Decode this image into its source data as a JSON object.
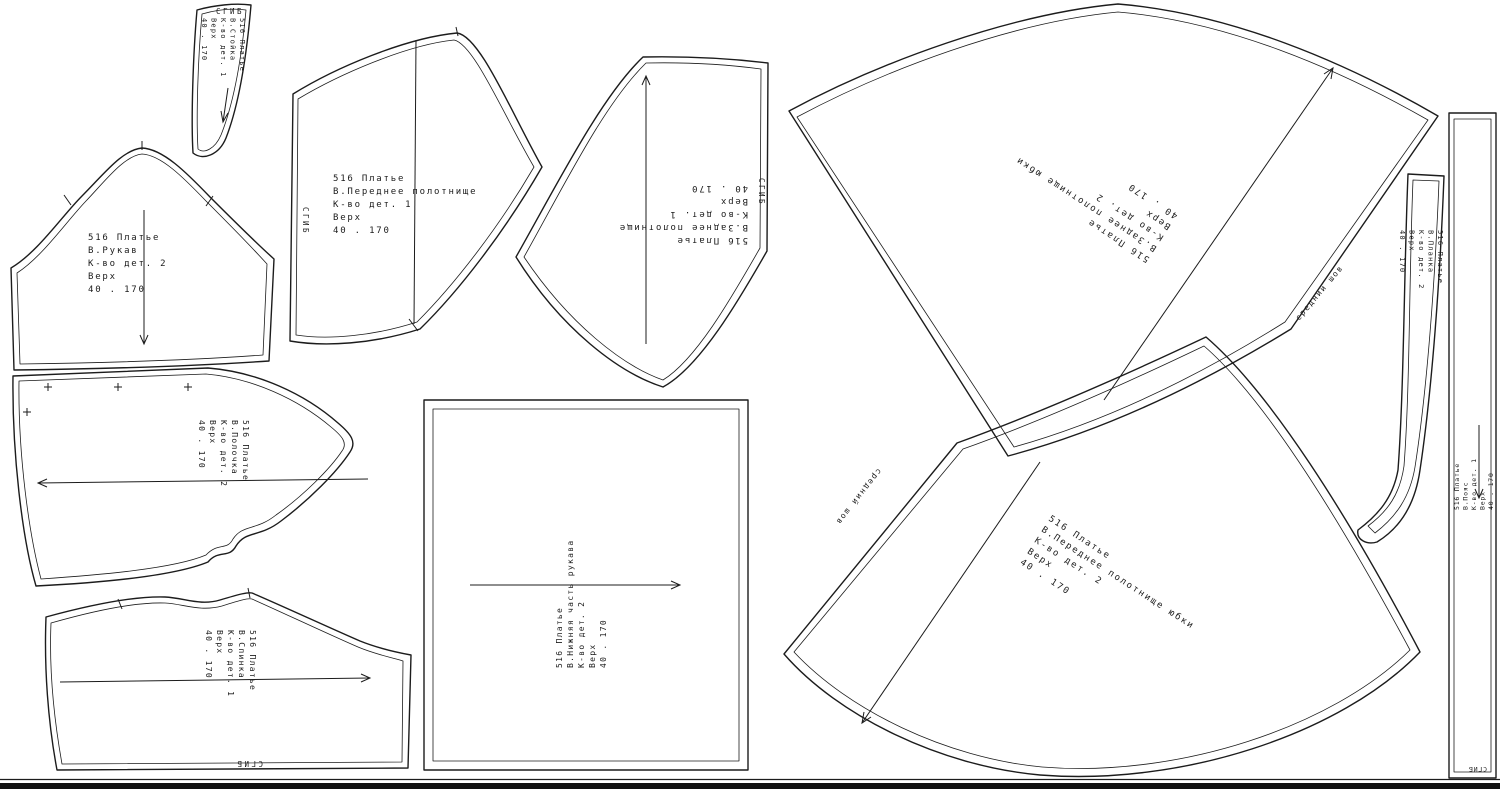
{
  "canvas": {
    "background": "#ffffff",
    "line_color": "#1c1c1c",
    "bottom_bar_color": "#111111",
    "width": 1500,
    "height": 789
  },
  "labels": {
    "fold": "СГИБ",
    "center_seam": "средний шов"
  },
  "pieces": {
    "stoika": {
      "lines": [
        "516 Платье",
        "В.Стойка",
        "К-во дет. 1",
        "Верх",
        "40 . 170"
      ]
    },
    "rukav": {
      "lines": [
        "516 Платье",
        "В.Рукав",
        "К-во дет. 2",
        "Верх",
        "40 . 170"
      ]
    },
    "perednee": {
      "lines": [
        "516 Платье",
        "В.Переднее полотнище",
        "К-во дет. 1",
        "Верх",
        "40 . 170"
      ]
    },
    "zadnee": {
      "lines": [
        "516 Платье",
        "В.Заднее полотнище",
        "К-во дет. 1",
        "Верх",
        "40 . 170"
      ]
    },
    "zadnee_yubki": {
      "lines": [
        "516 Платье",
        "В.Заднее полотнище юбки",
        "К-во дет. 2",
        "Верх",
        "40 . 170"
      ]
    },
    "perednee_yubki": {
      "lines": [
        "516 Платье",
        "В.Переднее полотнище юбки",
        "К-во дет. 2",
        "Верх",
        "40 . 170"
      ]
    },
    "polochka": {
      "lines": [
        "516 Платье",
        "В.Полочка",
        "К-во дет. 2",
        "Верх",
        "40 . 170"
      ]
    },
    "spinka": {
      "lines": [
        "516 Платье",
        "В.Спинка",
        "К-во дет. 1",
        "Верх",
        "40 . 170"
      ]
    },
    "nizhnyaya": {
      "lines": [
        "516 Платье",
        "В.Нижняя часть рукава",
        "К-во дет. 2",
        "Верх",
        "40 . 170"
      ]
    },
    "poyas": {
      "lines": [
        "516 Платье",
        "В.Пояс",
        "К-во дет. 1",
        "Верх",
        "40 . 170"
      ]
    },
    "planka": {
      "lines": [
        "516 Платье",
        "В.Планка",
        "К-во дет. 2",
        "Верх",
        "40 . 170"
      ]
    }
  }
}
